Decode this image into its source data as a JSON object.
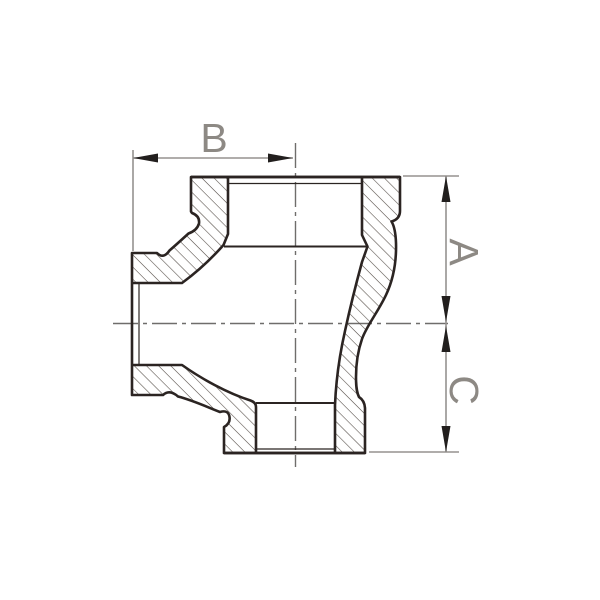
{
  "drawing": {
    "title": "reducing-tee-fitting-cross-section",
    "dimension_labels": {
      "width": "B",
      "upper_height": "A",
      "lower_height": "C"
    },
    "colors": {
      "background": "#ffffff",
      "outline": "#2b2422",
      "hatch": "#554d47",
      "dimension_line": "#95928f",
      "arrow": "#221f1e",
      "centerline": "#6f6d6b",
      "label": "#8d8984"
    }
  }
}
